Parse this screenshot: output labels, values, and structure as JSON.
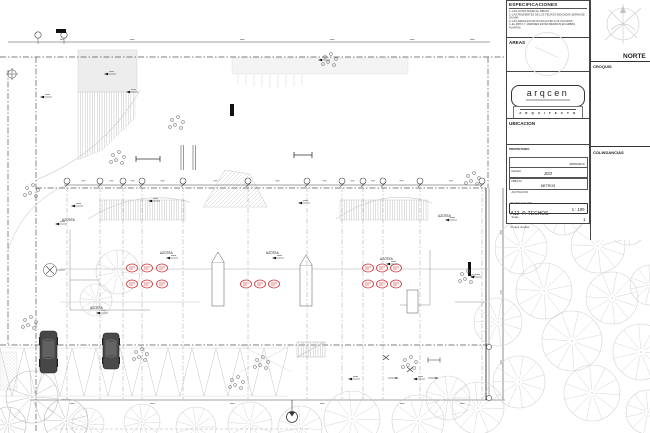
{
  "title_block": {
    "especificaciones": {
      "title": "ESPECIFICACIONES",
      "notes": [
        "1.-LAS COTAS RIGEN AL DIBUJO",
        "2.-LAS PENDIENTES DE LOS TECHOS INDICADAS SERAN DE 2% MIN.",
        "3.-LAS AREAS EN M2 NO INCLUYEN LOS VOLADOS",
        "4.-EL PATIO Y JARDINES ESTAN MEDIDOS EN AMBAS PLANTAS"
      ]
    },
    "areas_label": "AREAS",
    "logo_text": "arqcen",
    "architect_title": "A R Q U I T E C T O",
    "ubicacion_label": "UBICACION",
    "propietario_label": "PROPIETARIO",
    "fecha_label": "FECHA",
    "fecha_value": "28/05/2013",
    "dibujo_label": "DIBUJO",
    "dibujo_value": "JGO",
    "acotacion_label": "ACOTACION",
    "acotacion_value": "METROS",
    "plano_label": "PLANO Y CLAVE",
    "plano_code": "A12",
    "plano_name": "P. TECHOS",
    "scale_label": "Scale",
    "scale_value": "1 : 100",
    "project_label": "Project number",
    "project_value": "1",
    "norte_label": "NORTE",
    "croquis_label": "CROQUIS",
    "colindancias_label": "COLINDANCIAS"
  },
  "plan": {
    "azotea_label": "AZOTEA"
  },
  "colors": {
    "marker_red": "#cc3333"
  }
}
